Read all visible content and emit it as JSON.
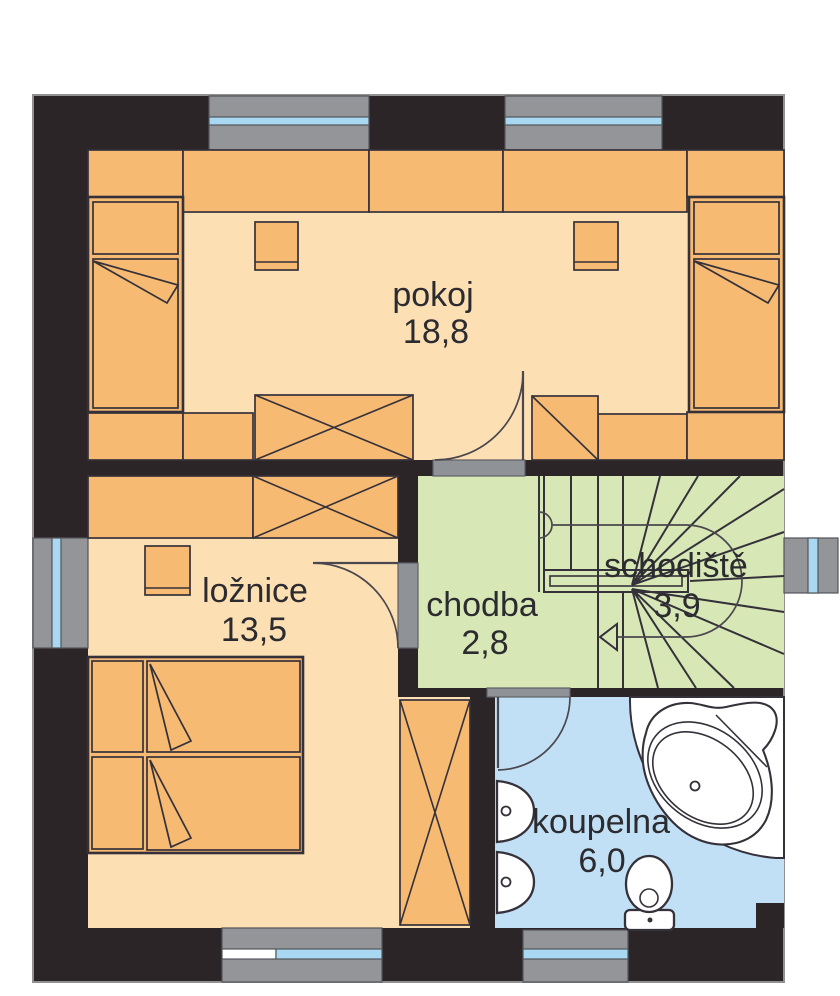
{
  "plan": {
    "rooms": [
      {
        "id": "pokoj",
        "label": "pokoj",
        "area": "18,8"
      },
      {
        "id": "loznice",
        "label": "ložnice",
        "area": "13,5"
      },
      {
        "id": "chodba",
        "label": "chodba",
        "area": "2,8"
      },
      {
        "id": "schodiste",
        "label": "schodiště",
        "area": "3,9"
      },
      {
        "id": "koupelna",
        "label": "koupelna",
        "area": "6,0"
      }
    ],
    "colors": {
      "wall": "#2b2528",
      "floor_warm": "#fcdfb3",
      "floor_green": "#d7e8b6",
      "floor_blue": "#c2e0f5",
      "furniture": "#f6ba72",
      "window_frame": "#939599",
      "window_glass": "#a9d8f3",
      "threshold": "#8f9296",
      "fixture": "#ffffff",
      "line": "#35313a",
      "text": "#2c2b2f",
      "background": "#ffffff"
    }
  }
}
